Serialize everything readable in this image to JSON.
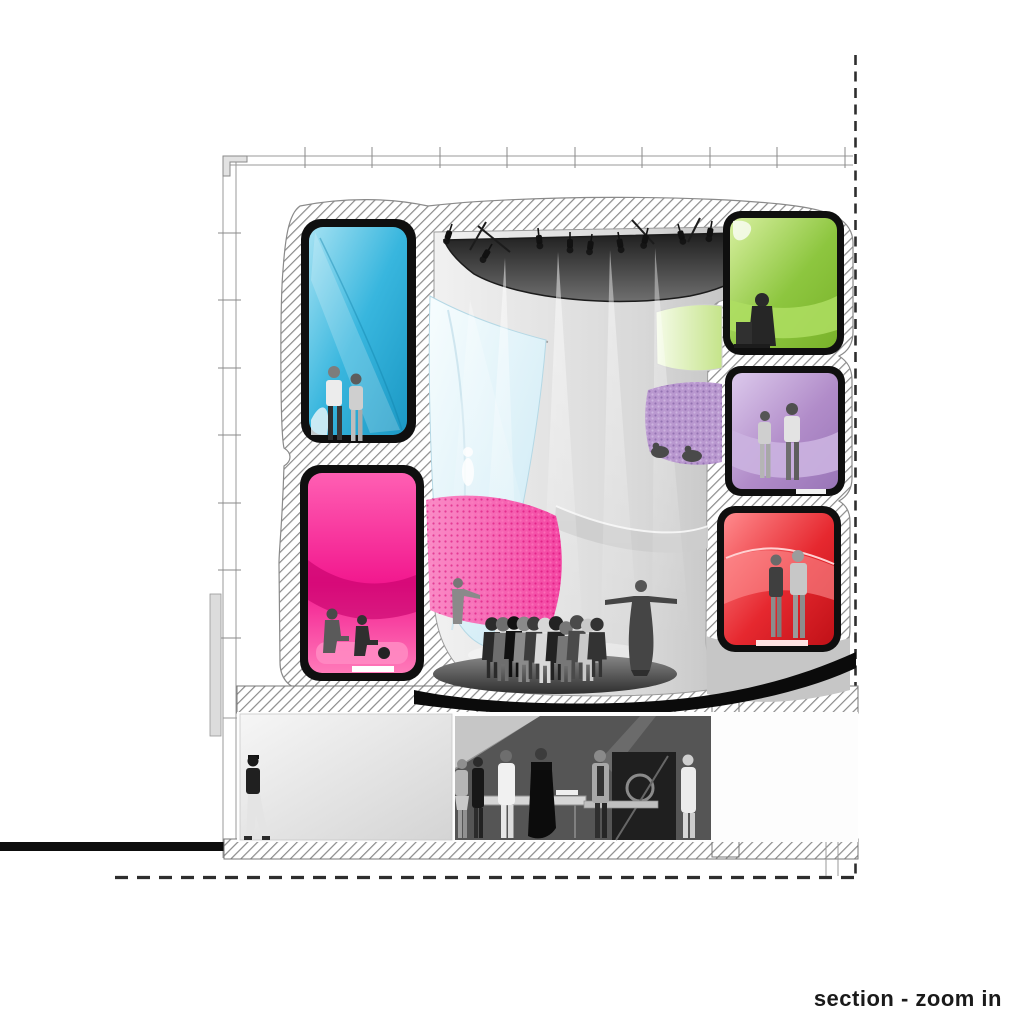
{
  "caption": {
    "label": "section - zoom in"
  },
  "colors": {
    "cyan": "#38b6de",
    "pink": "#f2188e",
    "green": "#8dc63f",
    "purple": "#b18cc9",
    "red": "#e6282f",
    "window_green": "#c5e48a",
    "ceiling_dark": "#2b2b2b",
    "hatch_line": "#8b8b8b",
    "ink": "#1a1a1a",
    "wall_gray": "#c9c9c9"
  },
  "rooms": [
    {
      "id": "pod-upper-left",
      "color": "#38b6de"
    },
    {
      "id": "pod-lower-left",
      "color": "#f2188e"
    },
    {
      "id": "pod-upper-right",
      "color": "#8dc63f"
    },
    {
      "id": "pod-mid-right",
      "color": "#b18cc9"
    },
    {
      "id": "pod-lower-right",
      "color": "#e6282f"
    }
  ]
}
